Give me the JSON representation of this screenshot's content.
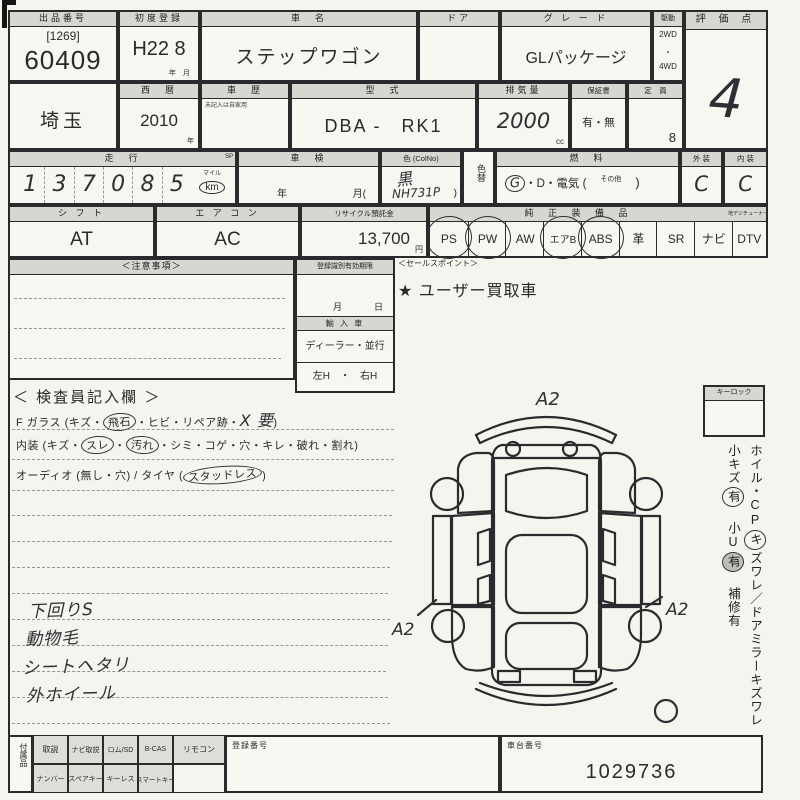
{
  "colors": {
    "paper": "#f5f4ef",
    "ink": "#2a2a2c",
    "header_bg": "#d7d6d0",
    "hand_ink": "#2e2e33"
  },
  "header_row": {
    "lot": {
      "label": "出品番号",
      "bracket": "[1269]",
      "number": "60409"
    },
    "first_reg": {
      "label": "初度登録",
      "value": "H22 8",
      "units": "年　月"
    },
    "car_name": {
      "label": "車　名",
      "value": "ステップワゴン"
    },
    "door": {
      "label": "ドア"
    },
    "grade": {
      "label": "グ レ ー ド",
      "value": "GLパッケージ"
    },
    "drive": {
      "label": "駆動",
      "opt1": "2WD",
      "sep": "・",
      "opt2": "4WD"
    },
    "score": {
      "label": "評 価 点",
      "value": "4"
    }
  },
  "detail_row": {
    "prefecture": {
      "value": "埼玉"
    },
    "year": {
      "label": "西　暦",
      "value": "2010",
      "unit": "年"
    },
    "history": {
      "label": "車　歴",
      "note": "未記入は自家用"
    },
    "model": {
      "label": "型　式",
      "value": "DBA -　RK1"
    },
    "displacement": {
      "label": "排気量",
      "value": "2000",
      "unit": "cc"
    },
    "warranty": {
      "label": "保証書",
      "value": "有・無"
    },
    "capacity": {
      "label": "定　員",
      "value": "8"
    }
  },
  "status_row": {
    "mileage": {
      "label": "走　行",
      "sp": "SP",
      "digits": [
        "1",
        "3",
        "7",
        "0",
        "8",
        "5"
      ],
      "unit_top": "マイル",
      "unit": "km"
    },
    "shaken": {
      "label": "車　検",
      "year_mark": "年",
      "month_mark": "月("
    },
    "color": {
      "label": "色 (ColNo)",
      "value": "黒",
      "code": "NH731P",
      "paren": ")"
    },
    "color_change": {
      "label": "色替"
    },
    "fuel": {
      "label": "燃　料",
      "gas": "G",
      "rest": "・D・電気 (",
      "other": "その他",
      "close": ")"
    },
    "exterior": {
      "label": "外 装",
      "value": "C"
    },
    "interior": {
      "label": "内 装",
      "value": "C"
    }
  },
  "equip_row": {
    "shift": {
      "label": "シ フ ト",
      "value": "AT"
    },
    "aircon": {
      "label": "エ ア コ ン",
      "value": "AC"
    },
    "recycle": {
      "label": "リサイクル預託金",
      "value": "13,700",
      "unit": "円"
    },
    "equipment": {
      "label": "純 正 装 備 品",
      "dtv_label": "地デジチューナー",
      "items": [
        {
          "label": "PS",
          "circled": true
        },
        {
          "label": "PW",
          "circled": true
        },
        {
          "label": "AW",
          "circled": false
        },
        {
          "label": "エアB",
          "circled": true
        },
        {
          "label": "ABS",
          "circled": true
        },
        {
          "label": "革",
          "circled": false
        },
        {
          "label": "SR",
          "circled": false
        },
        {
          "label": "ナビ",
          "circled": false
        },
        {
          "label": "DTV",
          "circled": false
        }
      ]
    }
  },
  "memo_row": {
    "notes": {
      "label": "＜注意事項＞"
    },
    "reg_limit": {
      "label": "登録識別有効期限",
      "month": "月",
      "day": "日",
      "import_label": "輸 入 車",
      "import_value": "ディーラー・並行",
      "handle_value": "左H　・　右H"
    },
    "sales": {
      "label": "＜セールスポイント＞",
      "value": "★ ユーザー買取車"
    }
  },
  "inspection": {
    "title": "＜ 検査員記入欄 ＞",
    "glass": {
      "prefix": "F ガラス (キズ・",
      "circled": "飛石",
      "mid": "・ヒビ・リペア跡・",
      "hand": "X 要",
      "suffix": ")"
    },
    "cabin": {
      "prefix": "内装 (キズ・",
      "circled1": "スレ",
      "dot": "・",
      "circled2": "汚れ",
      "suffix": "・シミ・コゲ・穴・キレ・破れ・割れ)"
    },
    "audio": {
      "prefix": "オーディオ (無し・穴) / タイヤ (",
      "circled": "スタッドレス",
      "suffix": ")"
    },
    "hand_notes": [
      "下回りS",
      "動物毛",
      "シートヘタリ",
      "外ホイール"
    ]
  },
  "diagram": {
    "mark_top": "A2",
    "mark_left": "A2",
    "mark_right": "A2"
  },
  "side_panel": {
    "keylock": "キーロック",
    "wheel_a": "ホイル・CP",
    "wheel_k": "キ",
    "wheel_b": "ズワレ／ドアミラーキズワレ",
    "scratch_a": "小キズ",
    "scratch_yu": "有",
    "scratch_b": "　小U",
    "scratch_yu2": "有",
    "scratch_c": "　補修有"
  },
  "bottom": {
    "accessories": "付属品",
    "row1": [
      "取説",
      "ナビ取説",
      "ロム/SD",
      "B-CAS",
      "リモコン"
    ],
    "row2": [
      "ナンバー",
      "スペアキー",
      "キーレス",
      "スマートキー"
    ],
    "reg_no_label": "登録番号",
    "chassis_label": "車台番号",
    "chassis_value": "1029736"
  }
}
